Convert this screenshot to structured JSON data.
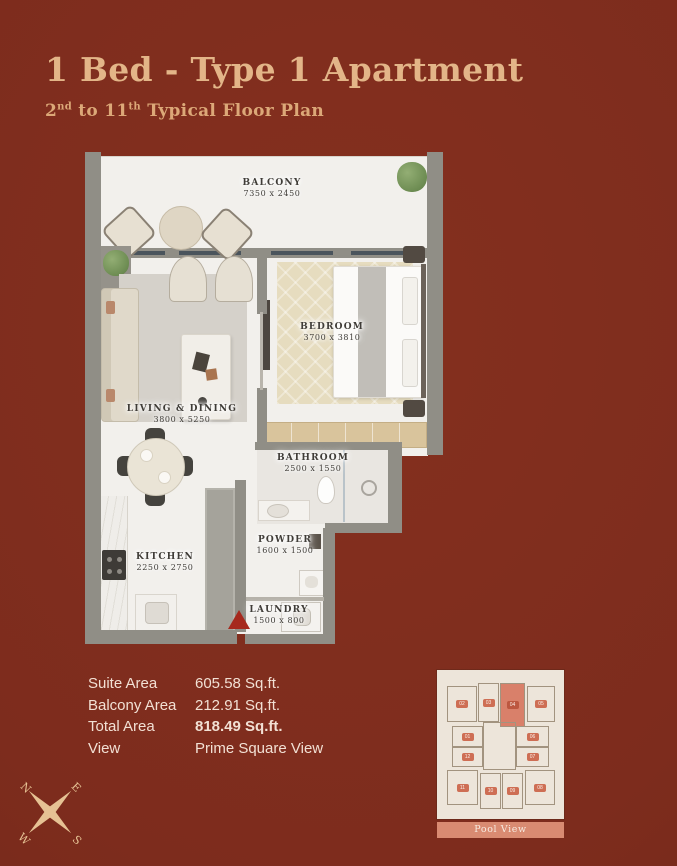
{
  "colors": {
    "background": "#7E2C1E",
    "accent_gold": "#E3B588",
    "salmon": "#D9826B",
    "plan_floor": "#F2F0EC",
    "entry_marker_red": "#A6291D"
  },
  "header": {
    "title": "1 Bed - Type 1 Apartment",
    "subtitle_prefix": "2",
    "subtitle_sup1": "nd",
    "subtitle_mid": " to 11",
    "subtitle_sup2": "th",
    "subtitle_rest": " Typical Floor Plan"
  },
  "floor_plan": {
    "rooms": {
      "balcony": {
        "name": "BALCONY",
        "dims": "7350 x 2450"
      },
      "living": {
        "name": "LIVING & DINING",
        "dims": "3800 x 5250"
      },
      "bedroom": {
        "name": "BEDROOM",
        "dims": "3700 x 3810"
      },
      "bathroom": {
        "name": "BATHROOM",
        "dims": "2500 x 1550"
      },
      "powder": {
        "name": "POWDER",
        "dims": "1600 x 1500"
      },
      "kitchen": {
        "name": "KITCHEN",
        "dims": "2250 x 2750"
      },
      "laundry": {
        "name": "LAUNDRY",
        "dims": "1500 x 800"
      }
    }
  },
  "specs": {
    "rows": [
      {
        "label": "Suite Area",
        "value": "605.58 Sq.ft."
      },
      {
        "label": "Balcony Area",
        "value": "212.91 Sq.ft."
      },
      {
        "label": "Total Area",
        "value": "818.49 Sq.ft."
      },
      {
        "label": "View",
        "value": "Prime Square View"
      }
    ]
  },
  "key_plan": {
    "highlighted_unit": "04",
    "footer": "Pool View",
    "units": [
      {
        "label": "02"
      },
      {
        "label": "03"
      },
      {
        "label": "04"
      },
      {
        "label": "05"
      },
      {
        "label": "01"
      },
      {
        "label": "12"
      },
      {
        "label": "06"
      },
      {
        "label": "07"
      },
      {
        "label": "11"
      },
      {
        "label": "10"
      },
      {
        "label": "09"
      },
      {
        "label": "08"
      }
    ]
  },
  "compass": {
    "n": "N",
    "e": "E",
    "s": "S",
    "w": "W"
  }
}
